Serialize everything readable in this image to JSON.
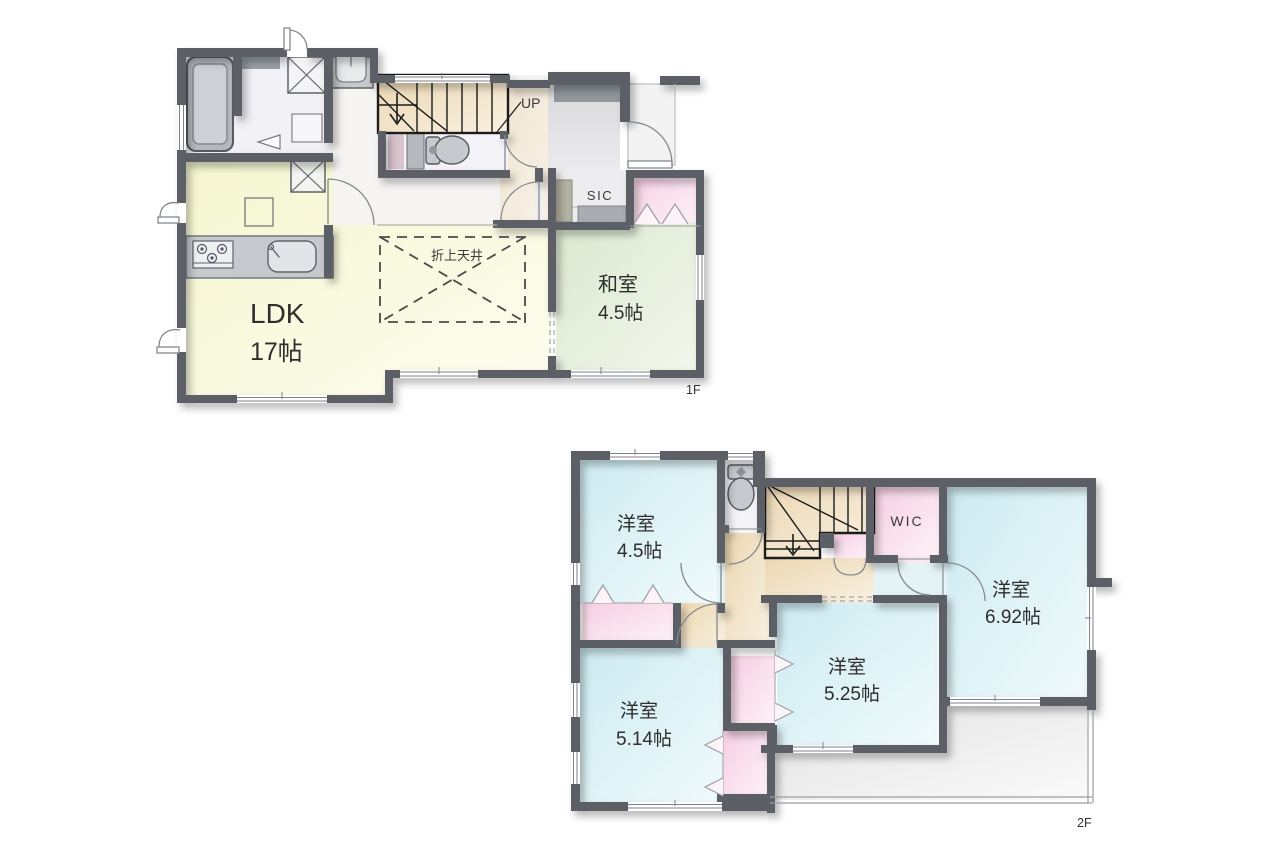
{
  "floor1": {
    "label": "1F",
    "rooms": {
      "ldk": {
        "name": "LDK",
        "size": "17帖"
      },
      "washitsu": {
        "name": "和室",
        "size": "4.5帖"
      },
      "sic": "SIC"
    },
    "stairs_up": "UP",
    "ceiling_note": "折上天井"
  },
  "floor2": {
    "label": "2F",
    "rooms": {
      "bedroom_a": {
        "name": "洋室",
        "size": "4.5帖"
      },
      "bedroom_b": {
        "name": "洋室",
        "size": "6.92帖"
      },
      "bedroom_c": {
        "name": "洋室",
        "size": "5.25帖"
      },
      "bedroom_d": {
        "name": "洋室",
        "size": "5.14帖"
      },
      "wic": "WIC"
    }
  },
  "colors": {
    "wall": "#5b6066",
    "stair_line": "#1c1c1c",
    "ldk": "#f6f7d8",
    "tatami": "#e0e9d5",
    "bedroom": "#d6eef3",
    "closet": "#f6d3e5",
    "stairs_hall": "#edd9b6",
    "balcony": "#e9e9ea"
  }
}
